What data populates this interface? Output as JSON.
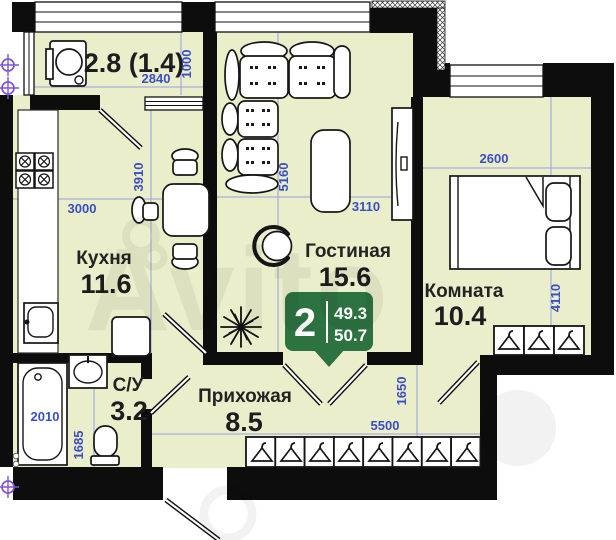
{
  "badge": {
    "rooms_count": "2",
    "area_living": "49.3",
    "area_total": "50.7",
    "color": "#2d7341"
  },
  "rooms": {
    "balcony": {
      "area_label": "2.8 (1.4)",
      "width_mm": "2840",
      "height_mm": "1000"
    },
    "kitchen": {
      "name": "Кухня",
      "area": "11.6",
      "width_mm": "3000",
      "height_mm": "3910"
    },
    "living": {
      "name": "Гостиная",
      "area": "15.6",
      "width_mm": "3110",
      "height_mm": "5160"
    },
    "bedroom": {
      "name": "Комната",
      "area": "10.4",
      "width_mm": "2600",
      "height_mm": "4110"
    },
    "hallway": {
      "name": "Прихожая",
      "area": "8.5",
      "width_mm": "5500",
      "height_mm": "1650"
    },
    "bathroom": {
      "name": "С/У",
      "area": "3.2",
      "tub_mm": "2010",
      "width_mm": "1685"
    }
  },
  "watermark": {
    "text": "Avito"
  },
  "colors": {
    "room_fill": "#eaeecb",
    "wall": "#0d0d0d",
    "dimension_blue": "#3a4fc4",
    "badge_green": "#2d7341",
    "axis_marker_purple": "#7e57d0"
  }
}
